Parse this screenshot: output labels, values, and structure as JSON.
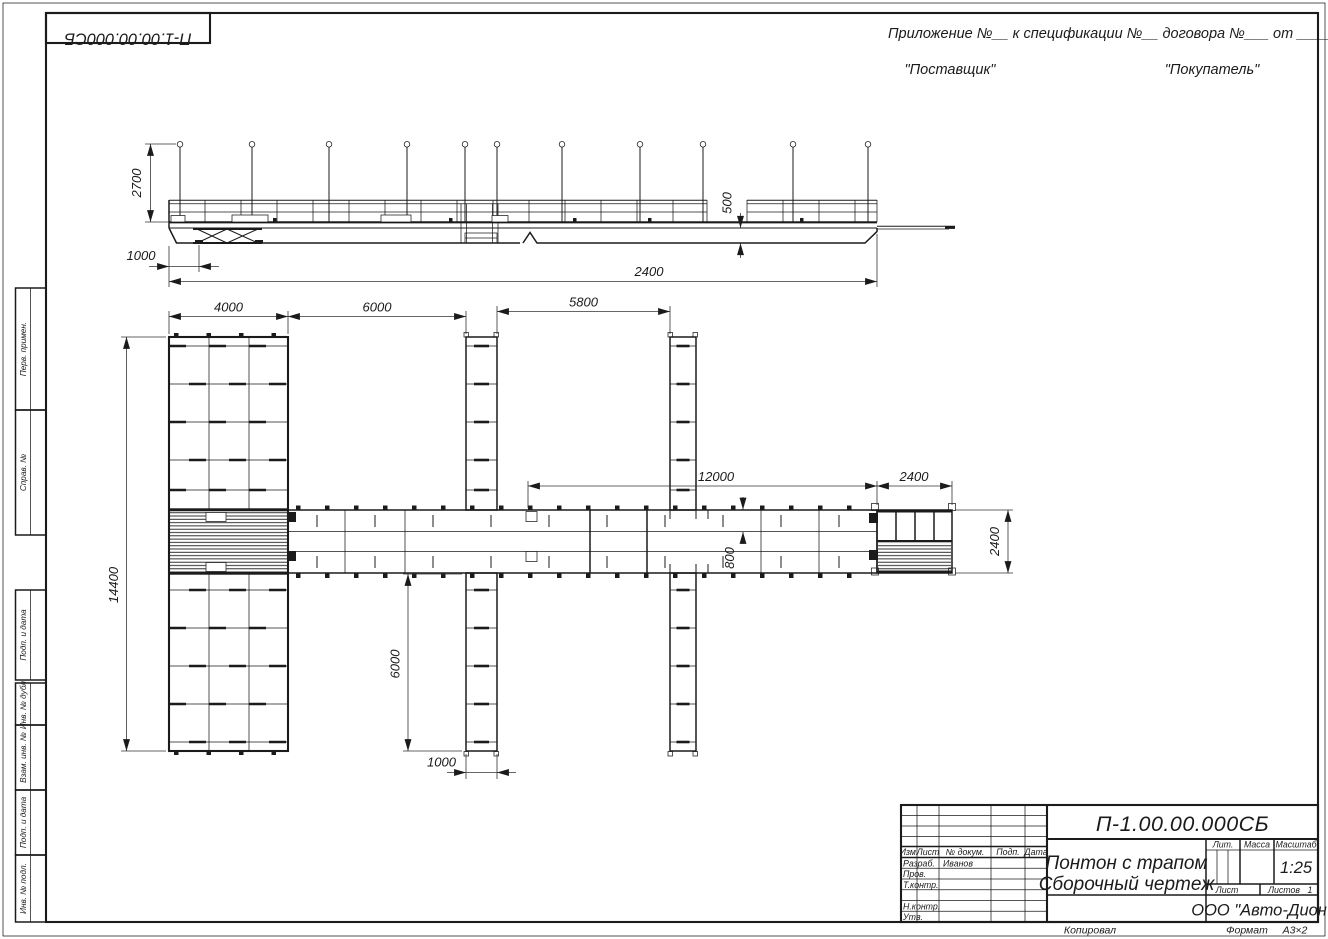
{
  "sheet": {
    "doc_number_mirrored": "П-1.00.00.000СБ",
    "appendix": "Приложение №__      к спецификации №__    договора №___    от _________",
    "supplier": "\"Поставщик\"",
    "buyer": "\"Покупатель\"",
    "copied": "Копировал",
    "format_label": "Формат",
    "format_value": "А3×2"
  },
  "margin": {
    "f0": "Перв. примен.",
    "f1": "Справ. №",
    "f2": "Подп. и дата",
    "f3": "Инв. № дубл.",
    "f4": "Взам. инв. №",
    "f5": "Подп. и дата",
    "f6": "Инв. № подл."
  },
  "tb": {
    "doc_number": "П-1.00.00.000СБ",
    "name1": "Понтон с трапом",
    "name2": "Сборочный чертеж",
    "company": "ООО \"Авто-Дион\"",
    "h_izm": "Изм.",
    "h_list": "Лист",
    "h_doc": "№ докум.",
    "h_podp": "Подп.",
    "h_data": "Дата",
    "r_razrab": "Разраб.",
    "v_razrab": "Иванов",
    "r_prov": "Пров.",
    "r_tkontr": "Т.контр.",
    "r_nkontr": "Н.контр.",
    "r_utv": "Утв.",
    "lit": "Лит.",
    "massa": "Масса",
    "masshtab": "Масштаб",
    "scale": "1:25",
    "list": "Лист",
    "listov": "Листов",
    "listov_val": "1"
  },
  "dims": {
    "elev_height": "2700",
    "elev_offset": "1000",
    "elev_freeboard": "500",
    "elev_total": "2400",
    "head_width": "4000",
    "gap1": "6000",
    "gap2": "5800",
    "walkway_len": "12000",
    "end_len": "2400",
    "head_len": "14400",
    "walk_width": "800",
    "finger_len": "6000",
    "finger_width": "1000",
    "end_width": "2400"
  }
}
